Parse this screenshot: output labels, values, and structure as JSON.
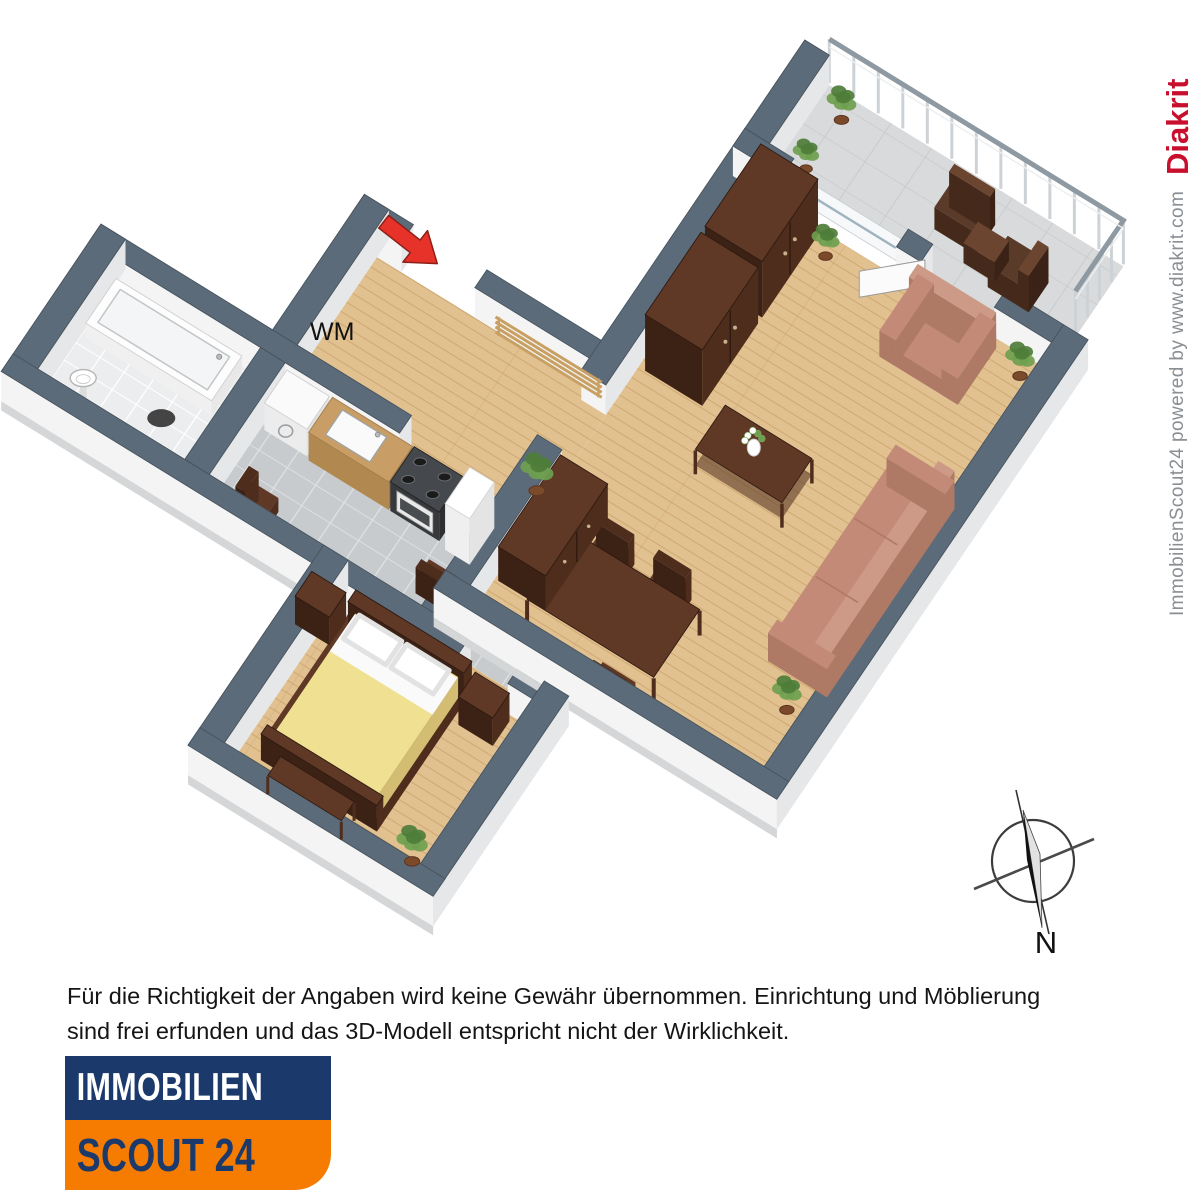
{
  "plan_labels": {
    "washing_machine": "WM",
    "compass_north": "N"
  },
  "watermark": {
    "credit": "ImmobilienScout24 powered by www.diakrit.com",
    "brand": "Diakrit"
  },
  "disclaimer": {
    "line1": "Für die Richtigkeit der Angaben wird keine Gewähr übernommen. Einrichtung und Möblierung",
    "line2": "sind frei erfunden und das 3D-Modell entspricht nicht der Wirklichkeit."
  },
  "logo": {
    "line1": "IMMOBILIEN",
    "line2": "SCOUT 24"
  },
  "colors": {
    "wall_top": "#5c6b79",
    "wall_edge": "#46535e",
    "wall_side": "#f4f4f4",
    "wall_side_dark": "#e6e7e8",
    "wall_skirt": "#d4d6d7",
    "floor_wood": "#e2c191",
    "wood_stripe": "#c9a268",
    "floor_tile": "#c7cbce",
    "tile_line": "#e0e3e5",
    "floor_bath": "#ebedee",
    "bath_line": "#ffffff",
    "floor_balcony": "#d8dadb",
    "balcony_line": "#c5c8ca",
    "furn_dark": "#4e2d1d",
    "furn_dark_top": "#5f3826",
    "furn_dark_side": "#3c2115",
    "sofa": "#c38b77",
    "sofa_dark": "#ae7a66",
    "sofa_light": "#cd9a87",
    "bed_yellow": "#f0e092",
    "white": "#ffffff",
    "plant_green": "#4e7d3a",
    "plant_green_light": "#6fa04f",
    "plant_pot": "#7b4a2b",
    "rack_wood": "#c9a063",
    "arrow_red": "#e63228",
    "arrow_red_dark": "#8d1f17",
    "navy": "#1b3a6b",
    "orange": "#f57c00",
    "text_dark": "#151515",
    "watermark_gray": "#8a8f94",
    "diakrit_red": "#c8102e",
    "compass_dark": "#222222"
  }
}
